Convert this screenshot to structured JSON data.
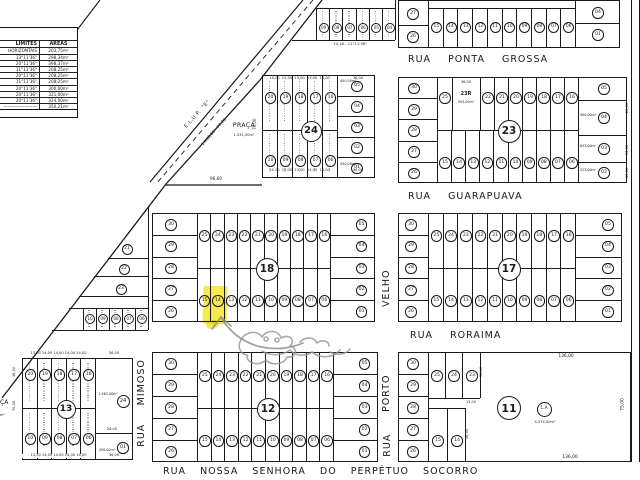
{
  "colors": {
    "ink": "#1a1a1a",
    "paper": "#ffffff",
    "highlight": "#f2e52e",
    "pencil": "#8f8f8f"
  },
  "table": {
    "header": [
      "LIMITES",
      "AREAS"
    ],
    "rows": [
      [
        "HORIZONTAIS",
        "203,75m²"
      ],
      [
        "13°11'36\"",
        "298,34m²"
      ],
      [
        "20°11'36\"",
        "398,37m²"
      ],
      [
        "11°11'36\"",
        "208,25m²"
      ],
      [
        "20°11'36\"",
        "208,25m²"
      ],
      [
        "11°11'36\"",
        "208,25m²"
      ],
      [
        "20°11'36\"",
        "300,00m²"
      ],
      [
        "20°11'36\"",
        "321,00m²"
      ],
      [
        "20°11'36\"",
        "324,00m²"
      ],
      [
        "————————",
        "350,21m²"
      ]
    ]
  },
  "streets": {
    "ponta_grossa": "RUA PONTA GROSSA",
    "guarapuava": "RUA GUARAPUAVA",
    "roraima": "RUA RORAIMA",
    "socorro": "RUA NOSSA SENHORA DO PERPÉTUO SOCORRO",
    "mimoso_name": "MIMOSO",
    "mimoso_rua": "RUA",
    "pv_velho": "VELHO",
    "pv_porto": "PORTO",
    "pv_rua": "RUA"
  },
  "elup": {
    "l1": "E.L.U.P.  \"E\"",
    "l2": "1.100,00 - 77,73"
  },
  "praca": {
    "name": "PRAÇA",
    "area": "1.531,00m²",
    "frontage": "96,60",
    "fragment": "ÇA",
    "fragment2": "m²"
  },
  "annotations": {
    "highlighted_lot": "14",
    "highlight_color": "#f2e52e",
    "pencil_color": "#8f8f8f"
  },
  "blocks": {
    "q24": {
      "number": "24",
      "top_row": [
        "20",
        "19",
        "18",
        "17",
        "16"
      ],
      "bottom_row": [
        "10",
        "09",
        "08",
        "07",
        "06"
      ],
      "right_col": [
        "05",
        "04",
        "03",
        "02",
        "01"
      ],
      "areas": {
        "lot05": "450,00m²",
        "lot01": "450,00m²"
      },
      "dims": {
        "top": "14,10  13,50  13,00  13,00  13,00",
        "top_right": "36,00",
        "bottom": "14,10  13,00  13,00  13,00  13,00",
        "bottom_right": "36,00",
        "left": "70,00"
      }
    },
    "q23": {
      "number": "23",
      "left_col": [
        "30",
        "29",
        "28",
        "27",
        "26"
      ],
      "top_row": [
        "25",
        "22",
        "21",
        "20",
        "19",
        "18",
        "17",
        "16"
      ],
      "special": {
        "label": "23R",
        "area": "953,00m²",
        "dim": "36,00"
      },
      "bottom_row": [
        "15",
        "14",
        "13",
        "12",
        "11",
        "10",
        "09",
        "08",
        "07",
        "06"
      ],
      "right_col": [
        "05",
        "04",
        "03",
        "02"
      ],
      "right_areas": [
        "900,00m²",
        "633,00m²",
        "523,00m²"
      ],
      "right_dims": [
        "26,00",
        "13,00",
        "13,00"
      ]
    },
    "q18": {
      "number": "18",
      "left_col": [
        "30",
        "29",
        "28",
        "27",
        "26"
      ],
      "top_row": [
        "25",
        "24",
        "23",
        "22",
        "21",
        "20",
        "19",
        "18",
        "17",
        "16"
      ],
      "bottom_row": [
        "15",
        "14",
        "13",
        "12",
        "11",
        "10",
        "09",
        "08",
        "07",
        "06"
      ],
      "right_col": [
        "05",
        "04",
        "03",
        "02",
        "01"
      ]
    },
    "q17": {
      "number": "17",
      "left_col": [
        "30",
        "29",
        "28",
        "27",
        "26"
      ],
      "top_row": [
        "25",
        "24",
        "23",
        "22",
        "21",
        "20",
        "19",
        "18",
        "17",
        "16"
      ],
      "bottom_row": [
        "15",
        "14",
        "13",
        "12",
        "11",
        "10",
        "09",
        "08",
        "07",
        "06"
      ],
      "right_col": [
        "05",
        "04",
        "03",
        "02",
        "01"
      ]
    },
    "q12": {
      "number": "12",
      "left_col": [
        "30",
        "29",
        "28",
        "27",
        "26"
      ],
      "top_row": [
        "25",
        "24",
        "23",
        "22",
        "21",
        "20",
        "19",
        "18",
        "17",
        "16"
      ],
      "bottom_row": [
        "15",
        "14",
        "13",
        "12",
        "11",
        "10",
        "09",
        "08",
        "07",
        "06"
      ],
      "right_col": [
        "05",
        "04",
        "03",
        "02",
        "01"
      ]
    },
    "q13": {
      "number": "13",
      "top_row": [
        "20",
        "19",
        "18",
        "17",
        "16"
      ],
      "bottom_row": [
        "10",
        "09",
        "08",
        "07",
        "06"
      ],
      "lot24": {
        "label": "24",
        "area": "1.563,00m²"
      },
      "lot01": {
        "label": "01",
        "area": "450,00m²"
      },
      "dims": {
        "top": "13,00 14,00 14,00 14,00 14,00",
        "top_right": "36,00",
        "bottom": "13,20 14,00 14,00 14,00 14,00",
        "bottom_right": "36,00",
        "mid": "26,00",
        "left_upper": "36,00",
        "left_lower": "70,00"
      }
    },
    "q11": {
      "number": "11",
      "left_col": [
        "30",
        "29",
        "28",
        "27",
        "26"
      ],
      "top_lots": [
        "25",
        "24",
        "23"
      ],
      "bottom_lots": [
        "15",
        "14"
      ],
      "lot1a": {
        "label": "1.A",
        "area": "4.274,00m²"
      },
      "dims": {
        "top": "136,00",
        "bottom": "136,00",
        "right": "75,00",
        "step": "13,00",
        "v1": "36,00",
        "v2": "36,00"
      }
    },
    "qtop": {
      "left_col": [
        "27",
        "26"
      ],
      "strip": [
        "15",
        "14",
        "13",
        "12",
        "11",
        "10",
        "09",
        "08",
        "07",
        "06"
      ],
      "right_col": [
        "04",
        "01"
      ]
    },
    "qsmall": {
      "lots": [
        "09",
        "08",
        "07",
        "06",
        "05",
        "04"
      ],
      "bottom_label": "74,16 - 11°11'36\""
    },
    "qtri": {
      "lots": [
        "21",
        "22",
        "23"
      ],
      "bottom_row": [
        "10",
        "09",
        "08",
        "07",
        "06"
      ]
    }
  }
}
